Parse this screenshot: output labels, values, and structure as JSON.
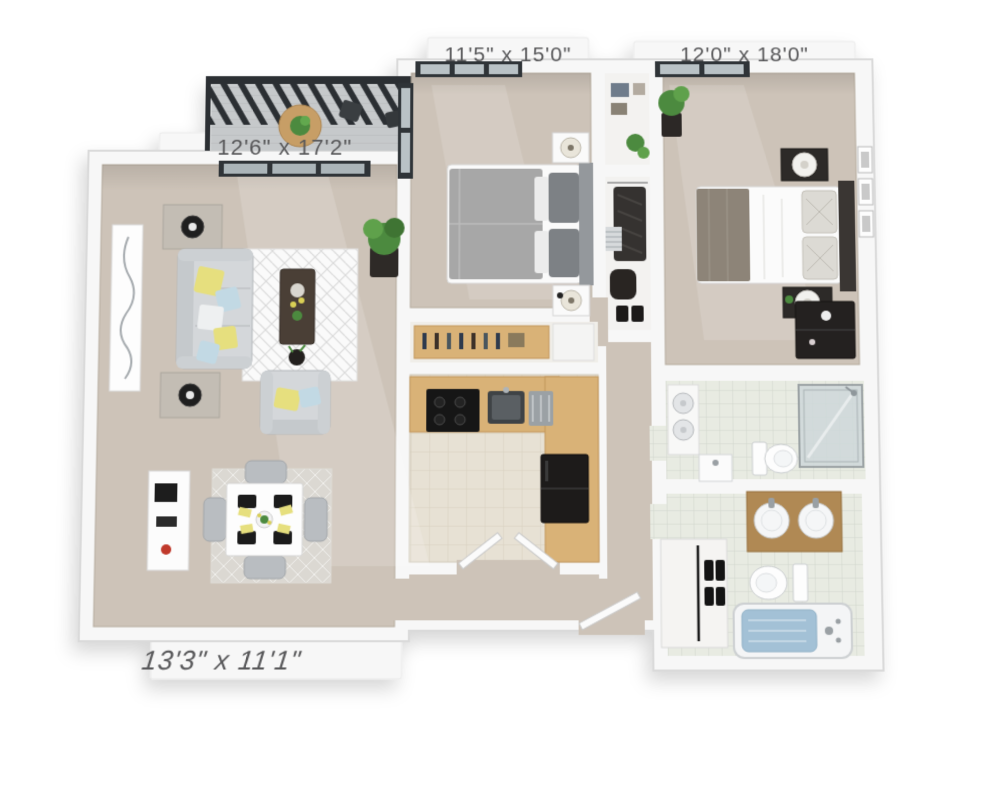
{
  "scene": {
    "type": "3d-apartment-floor-plan",
    "background": "#ffffff"
  },
  "floor_plan": {
    "dimension_labels": {
      "bedroom_1": "11'5\" x 15'0\"",
      "bedroom_2": "12'0\" x 18'0\"",
      "living_room": "12'6\" x 17'2\"",
      "dining_room": "13'3\" x 11'1\""
    },
    "palette": {
      "background": "#ffffff",
      "wall": "#f7f7f7",
      "wall_edge": "#dadada",
      "floor_main": "#cdc3b8",
      "tile_kitchen": "#e7e1d4",
      "tile_bath": "#e8ebe2",
      "counter_wood": "#d9b277",
      "vanity_wood": "#b08954",
      "railing_dark": "#2b2f33",
      "furniture_gray": "#d4d7da",
      "furniture_dark": "#2a2725",
      "accent_yellow": "#e6df7e",
      "accent_blue": "#c2d9e4",
      "plant_green": "#4c8a3f",
      "water_blue": "#a3c1d6",
      "label_text": "#58585a"
    }
  }
}
